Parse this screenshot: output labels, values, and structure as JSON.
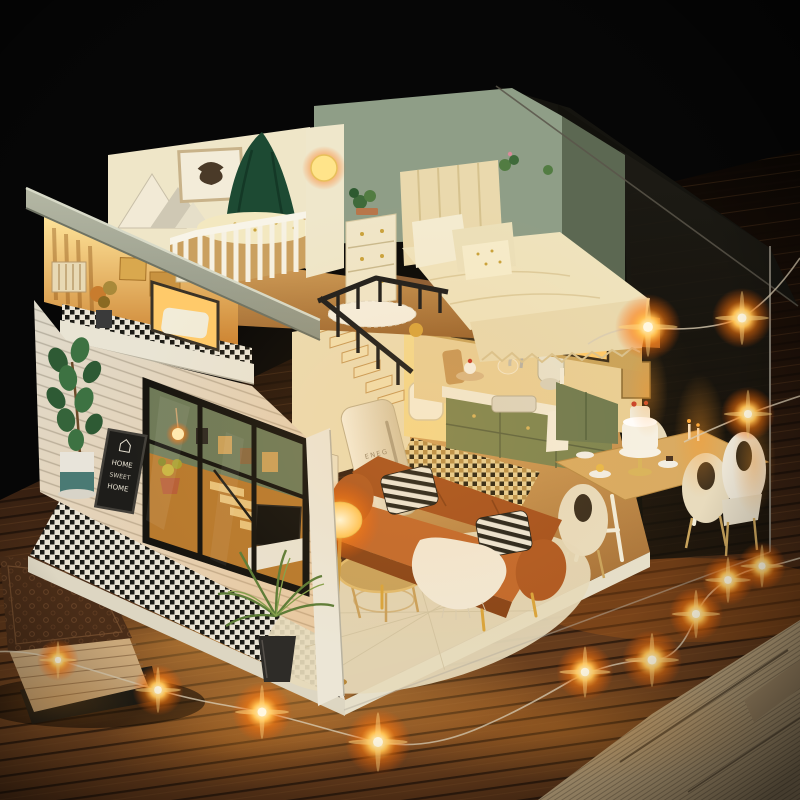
{
  "image": {
    "kind": "photograph",
    "subject": "Miniature DIY loft dollhouse glowing warm inside a clear acrylic dust cover, standing on a dark plank table wrapped with lit copper fairy-light strings; a carved antique book lies at lower left and an old newspaper at lower right against a black background.",
    "lighting": "warm interior LEDs and orange fairy lights on a dark scene"
  },
  "texts": {
    "fridge_brand": "ENEG",
    "wall_poster": "ISSE",
    "chalkboard_line1": "HOME",
    "chalkboard_line2": "SWEET",
    "chalkboard_line3": "HOME"
  },
  "objects": [
    "sloped grey roof panel",
    "lit attic storage room",
    "balcony with checkered floor",
    "white shiplap facade",
    "black framed glass doors",
    "fiddle-leaf fig in two-tone pot",
    "chalkboard welcome sign",
    "black-and-white tiled walkway",
    "potted palm at corner",
    "nursery with white crib and dark-green canopy",
    "highland-bull wall art",
    "mountain decor",
    "glowing moon wall lamp",
    "three-drawer dresser",
    "double bed with channel-tufted headboard",
    "sage-green bedroom wall",
    "black loft and stair railing",
    "wooden staircase",
    "cream retro fridge",
    "Matisse-style poster",
    "caramel leather sofa",
    "black-white striped pillows",
    "white throw blanket",
    "gold round coffee table",
    "glowing floor lamp",
    "patterned cream rug",
    "sage-green kitchen cabinets with sink and mixer",
    "dining trestle table",
    "cream shell chairs",
    "white layer cake on gold stand",
    "green hutch",
    "clear acrylic dust cover",
    "copper-wire fairy lights",
    "dark plank table top",
    "carved antique book",
    "vintage newspaper page"
  ],
  "colors": {
    "background": "#060606",
    "table_wood": "#5a3418",
    "warm_glow": "#ffb14a",
    "fairy_light": "#ffc050",
    "roof_panel": "#a9ac9a",
    "bedroom_wall": "#8f9e87",
    "sofa_leather": "#b05a24",
    "kitchen_cabinet": "#7d8551",
    "facade": "#e0dbcd",
    "bedding": "#efe3bd",
    "crib": "#f6f1e2",
    "canopy_green": "#1d4a33",
    "acrylic_tint": "#1b1a14"
  }
}
